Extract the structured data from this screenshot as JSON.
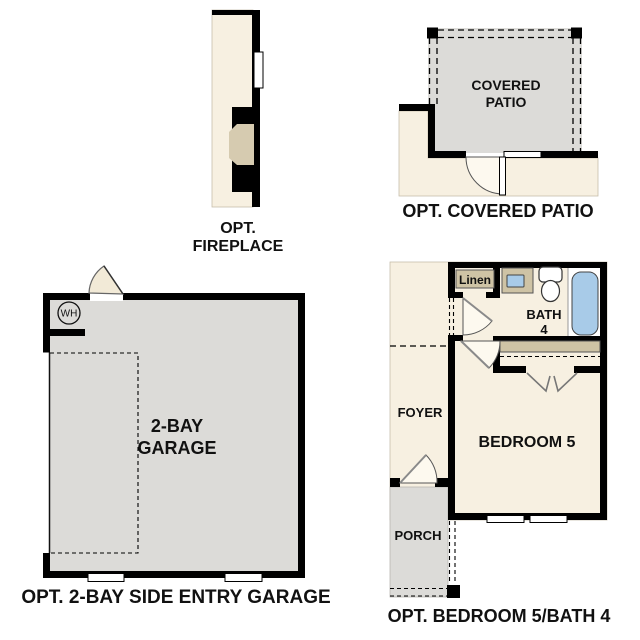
{
  "figures": {
    "fireplace": {
      "caption_line1": "OPT.",
      "caption_line2": "FIREPLACE"
    },
    "covered_patio": {
      "room_line1": "COVERED",
      "room_line2": "PATIO",
      "caption": "OPT. COVERED PATIO"
    },
    "garage": {
      "room_line1": "2-BAY",
      "room_line2": "GARAGE",
      "water_heater": "WH",
      "caption": "OPT. 2-BAY SIDE ENTRY GARAGE"
    },
    "bedroom5_bath4": {
      "linen": "Linen",
      "bath_line1": "BATH",
      "bath_line2": "4",
      "foyer": "FOYER",
      "bedroom": "BEDROOM 5",
      "porch": "PORCH",
      "caption": "OPT. BEDROOM 5/BATH 4"
    }
  },
  "colors": {
    "background": "#ffffff",
    "wall": "#000000",
    "floor_cream": "#f7f0e1",
    "floor_gray": "#dcdbd8",
    "cabinet_tan": "#cec3a5",
    "fixture_blue": "#a8cbe8"
  }
}
